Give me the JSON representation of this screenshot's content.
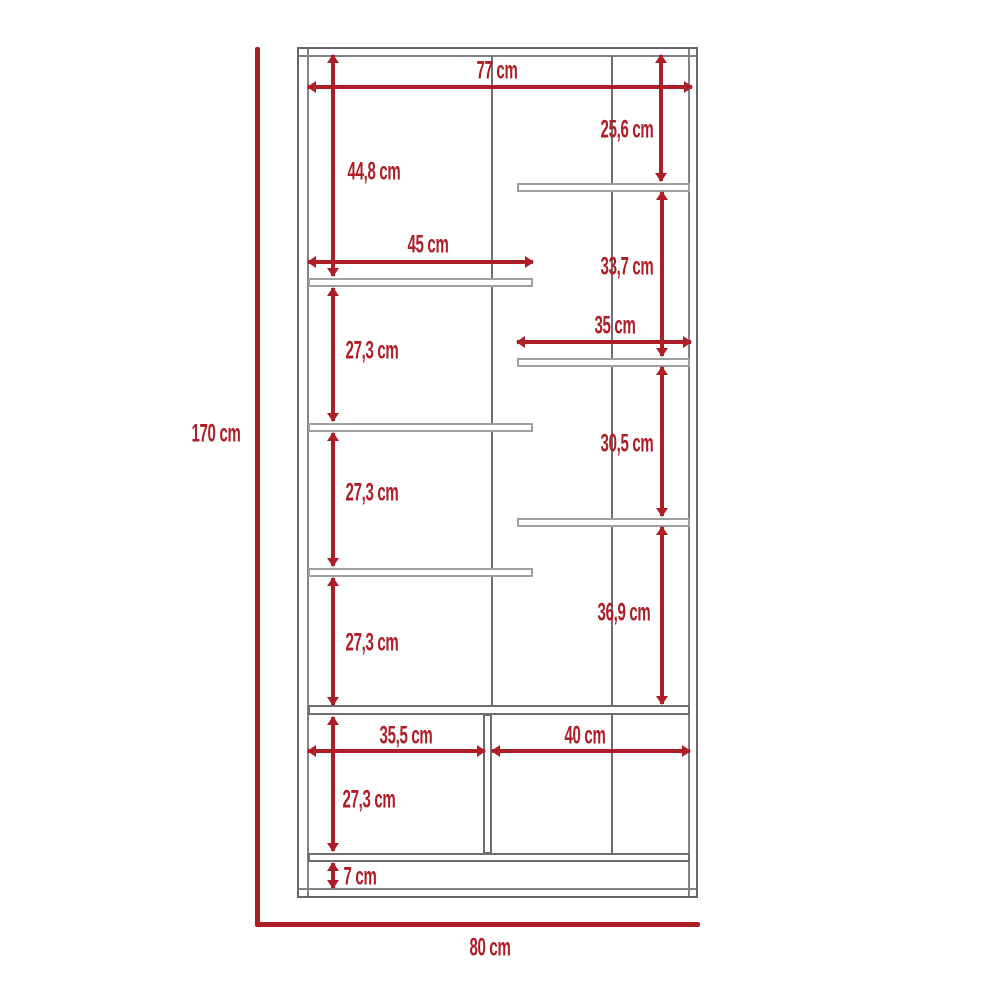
{
  "diagram": {
    "kind": "furniture-dimension-drawing",
    "unit": "cm",
    "colors": {
      "dimension_red": "#AE1E26",
      "outline_gray": "#66676A",
      "shelf_gray": "#9DA0A3"
    },
    "labels": {
      "width_top": "77 cm",
      "height_top_right": "25,6 cm",
      "height_top_left": "44,8 cm",
      "width_left_shelf": "45 cm",
      "height_right_2": "33,7 cm",
      "width_right_shelf": "35 cm",
      "height_left_2": "27,3 cm",
      "height_right_3": "30,5 cm",
      "height_left_3": "27,3 cm",
      "height_right_4": "36,9 cm",
      "height_left_4": "27,3 cm",
      "width_bottom_left": "35,5 cm",
      "width_bottom_right": "40 cm",
      "height_bottom_left": "27,3 cm",
      "height_base": "7 cm",
      "overall_height": "170 cm",
      "overall_width": "80 cm"
    }
  }
}
